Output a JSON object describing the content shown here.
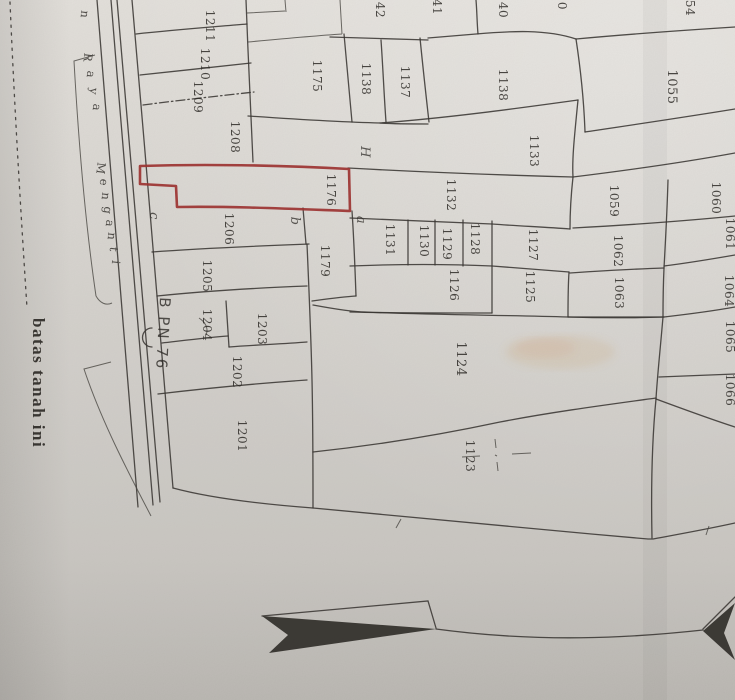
{
  "colors": {
    "paper": "#d5d2cd",
    "ink": "#3a3733",
    "red_outline": "#9c3331",
    "text_ink": "#2e2b27"
  },
  "map": {
    "road": {
      "name_visible": "n Raya Menganti",
      "letters": [
        {
          "t": "n",
          "x": 81,
          "y": 14
        },
        {
          "t": "R",
          "x": 84,
          "y": 57
        },
        {
          "t": "a",
          "x": 87,
          "y": 74
        },
        {
          "t": "y",
          "x": 90,
          "y": 91
        },
        {
          "t": "a",
          "x": 93,
          "y": 107
        },
        {
          "t": "M",
          "x": 97,
          "y": 168
        },
        {
          "t": "e",
          "x": 100,
          "y": 182
        },
        {
          "t": "n",
          "x": 102,
          "y": 196
        },
        {
          "t": "g",
          "x": 104,
          "y": 210
        },
        {
          "t": "a",
          "x": 106,
          "y": 223
        },
        {
          "t": "n",
          "x": 108,
          "y": 236
        },
        {
          "t": "t",
          "x": 110,
          "y": 249
        },
        {
          "t": "i",
          "x": 112,
          "y": 262
        }
      ]
    },
    "boundary_label": "batas tanah ini",
    "bpn_label": "B PN 76",
    "highlighted_parcel": "1176",
    "parcel_labels": [
      {
        "t": "1211",
        "x": 206,
        "y": 26
      },
      {
        "t": "1210",
        "x": 201,
        "y": 64
      },
      {
        "t": "1209",
        "x": 194,
        "y": 97
      },
      {
        "t": "1208",
        "x": 231,
        "y": 137
      },
      {
        "t": "1206",
        "x": 225,
        "y": 229
      },
      {
        "t": "1205",
        "x": 203,
        "y": 276
      },
      {
        "t": "1204",
        "x": 203,
        "y": 325
      },
      {
        "t": "1203",
        "x": 258,
        "y": 329
      },
      {
        "t": "1202",
        "x": 233,
        "y": 372
      },
      {
        "t": "1201",
        "x": 238,
        "y": 436
      },
      {
        "t": "1175",
        "x": 313,
        "y": 76
      },
      {
        "t": "1138",
        "x": 362,
        "y": 79
      },
      {
        "t": "1137",
        "x": 401,
        "y": 82
      },
      {
        "t": "1176",
        "x": 327,
        "y": 190
      },
      {
        "t": "1179",
        "x": 321,
        "y": 261
      },
      {
        "t": "1131",
        "x": 386,
        "y": 240
      },
      {
        "t": "1130",
        "x": 420,
        "y": 241
      },
      {
        "t": "1129",
        "x": 443,
        "y": 244
      },
      {
        "t": "1128",
        "x": 471,
        "y": 239
      },
      {
        "t": "1127",
        "x": 529,
        "y": 245
      },
      {
        "t": "1126",
        "x": 450,
        "y": 285
      },
      {
        "t": "1125",
        "x": 526,
        "y": 287
      },
      {
        "t": "1132",
        "x": 447,
        "y": 195
      },
      {
        "t": "1133",
        "x": 530,
        "y": 151
      },
      {
        "t": "1138",
        "x": 499,
        "y": 85
      },
      {
        "t": "1055",
        "x": 668,
        "y": 87,
        "big": true
      },
      {
        "t": "1059",
        "x": 610,
        "y": 201
      },
      {
        "t": "1060",
        "x": 712,
        "y": 198
      },
      {
        "t": "1061",
        "x": 726,
        "y": 234
      },
      {
        "t": "1062",
        "x": 614,
        "y": 251
      },
      {
        "t": "1063",
        "x": 615,
        "y": 293
      },
      {
        "t": "1064",
        "x": 725,
        "y": 291
      },
      {
        "t": "1065",
        "x": 726,
        "y": 337
      },
      {
        "t": "1066",
        "x": 726,
        "y": 390
      },
      {
        "t": "1124",
        "x": 457,
        "y": 359,
        "big": true
      },
      {
        "t": "1123",
        "x": 466,
        "y": 456
      }
    ],
    "partial_labels_top_edge": [
      {
        "t": "42",
        "x": 376,
        "y": 10
      },
      {
        "t": "41",
        "x": 433,
        "y": 7
      },
      {
        "t": "40",
        "x": 499,
        "y": 10
      },
      {
        "t": "0",
        "x": 558,
        "y": 6
      },
      {
        "t": "54",
        "x": 686,
        "y": 8
      }
    ],
    "handwritten_marks": [
      {
        "t": "c",
        "x": 150,
        "y": 216
      },
      {
        "t": "b",
        "x": 291,
        "y": 221
      },
      {
        "t": "a",
        "x": 357,
        "y": 220
      },
      {
        "t": "H",
        "x": 361,
        "y": 152
      }
    ]
  }
}
